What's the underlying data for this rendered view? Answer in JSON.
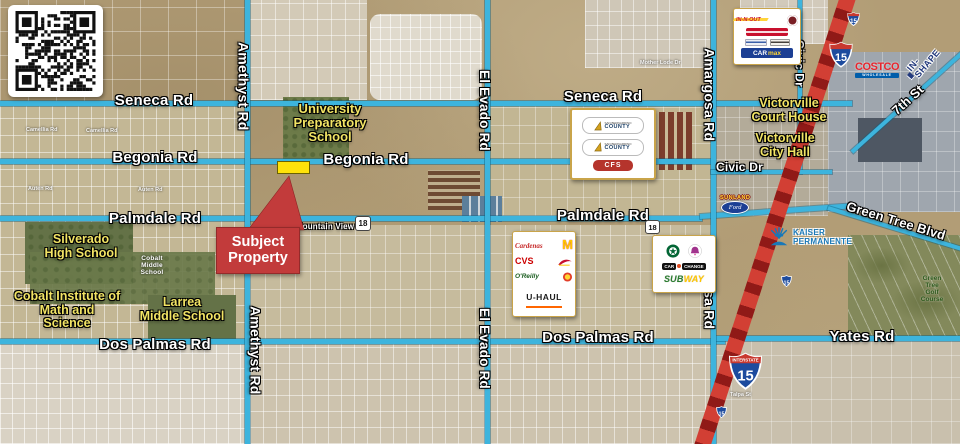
{
  "roads": {
    "seneca": "Seneca Rd",
    "begonia": "Begonia Rd",
    "palmdale": "Palmdale Rd",
    "dos_palmas": "Dos Palmas Rd",
    "yates": "Yates Rd",
    "amethyst": "Amethyst Rd",
    "el_evado": "El Evado Rd",
    "amargosa": "Amargosa Rd",
    "civic_dr": "Civic Dr",
    "seventh_st": "7th St",
    "green_tree": "Green Tree Blvd",
    "mountain_view": "Mountain View",
    "camellia": "Camellia Rd",
    "auten": "Auten Rd",
    "mother_lode": "Mother Lode Dr",
    "talpa": "Talpa St"
  },
  "places": {
    "university_prep": "University\nPreparatory\nSchool",
    "silverado": "Silverado\nHigh School",
    "cobalt_institute": "Cobalt Institute of\nMath and\nScience",
    "larrea": "Larrea\nMiddle School",
    "cobalt_middle": "Cobalt\nMiddle\nSchool",
    "court_house": "Victorville\nCourt House",
    "city_hall": "Victorville\nCity Hall",
    "golf_course": "Green Tree\nGolf Course"
  },
  "callout": {
    "text": "Subject\nProperty"
  },
  "shields": {
    "i15": "15",
    "sr18": "18",
    "interstate": "INTERSTATE"
  },
  "logos": {
    "in_n_out": "IN-N-OUT",
    "carmax_car": "CAR",
    "carmax_max": "max",
    "county_top": "SAN BERNARDINO",
    "county_bottom": "COUNTY",
    "cfs": "CFS",
    "cardenas": "Cardenas",
    "mcdonalds": "M",
    "cvs": "CVS",
    "oreilly": "O'Reilly",
    "uhaul": "U-HAUL",
    "car_change_1": "CAR",
    "car_change_2": "CHANGE",
    "subway_sub": "SUB",
    "subway_way": "WAY",
    "sunland": "SUNLAND",
    "ford": "Ford",
    "costco": "COSTCO",
    "costco_sub": "WHOLESALE",
    "in_shape": "IN-SHAPE",
    "kaiser": "KAISER\nPERMANENTE"
  },
  "colors": {
    "road_teal": "#3db4dd",
    "freeway_red": "#d23f34",
    "label_yellow": "#f2e465",
    "subject_red": "#c23b3b",
    "parcel_yellow": "#ffe20a"
  }
}
